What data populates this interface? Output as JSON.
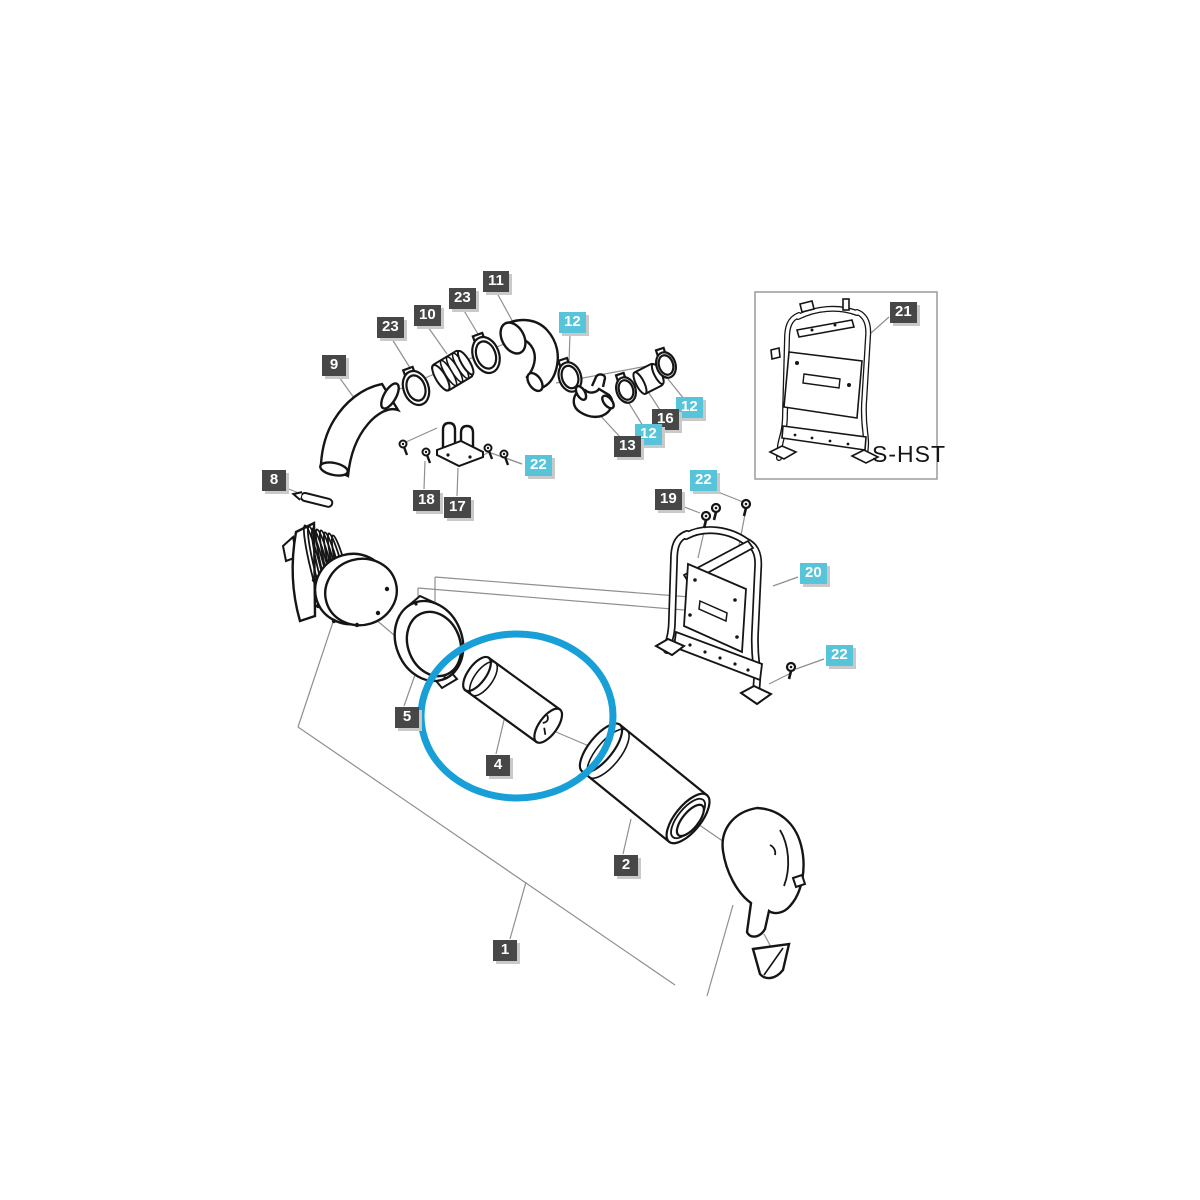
{
  "diagram": {
    "type": "exploded-parts-diagram",
    "subject": "air cleaner / filter assembly",
    "inset_caption": "S-HST",
    "highlight_color": "#189fd7",
    "line_color": "#151515",
    "leader_color": "#8f8f8f",
    "label_dark_bg": "#474747",
    "label_teal_bg": "#57c4d9",
    "highlighted_part": "4"
  },
  "callouts": [
    {
      "text": "23",
      "variant": "dark",
      "x": 377,
      "y": 317
    },
    {
      "text": "10",
      "variant": "dark",
      "x": 414,
      "y": 305
    },
    {
      "text": "23",
      "variant": "dark",
      "x": 449,
      "y": 288
    },
    {
      "text": "11",
      "variant": "dark",
      "x": 483,
      "y": 271
    },
    {
      "text": "12",
      "variant": "teal",
      "x": 559,
      "y": 312
    },
    {
      "text": "9",
      "variant": "dark",
      "x": 322,
      "y": 355
    },
    {
      "text": "12",
      "variant": "teal",
      "x": 676,
      "y": 397
    },
    {
      "text": "16",
      "variant": "dark",
      "x": 652,
      "y": 409
    },
    {
      "text": "12",
      "variant": "teal",
      "x": 635,
      "y": 424
    },
    {
      "text": "13",
      "variant": "dark",
      "x": 614,
      "y": 436
    },
    {
      "text": "8",
      "variant": "dark",
      "x": 262,
      "y": 470
    },
    {
      "text": "22",
      "variant": "teal",
      "x": 525,
      "y": 455
    },
    {
      "text": "18",
      "variant": "dark",
      "x": 413,
      "y": 490
    },
    {
      "text": "17",
      "variant": "dark",
      "x": 444,
      "y": 497
    },
    {
      "text": "19",
      "variant": "dark",
      "x": 655,
      "y": 489
    },
    {
      "text": "22",
      "variant": "teal",
      "x": 690,
      "y": 470
    },
    {
      "text": "20",
      "variant": "teal",
      "x": 800,
      "y": 563
    },
    {
      "text": "21",
      "variant": "dark",
      "x": 890,
      "y": 302
    },
    {
      "text": "22",
      "variant": "teal",
      "x": 826,
      "y": 645
    },
    {
      "text": "5",
      "variant": "dark",
      "x": 395,
      "y": 707
    },
    {
      "text": "4",
      "variant": "dark",
      "x": 486,
      "y": 755
    },
    {
      "text": "2",
      "variant": "dark",
      "x": 614,
      "y": 855
    },
    {
      "text": "1",
      "variant": "dark",
      "x": 493,
      "y": 940
    }
  ]
}
